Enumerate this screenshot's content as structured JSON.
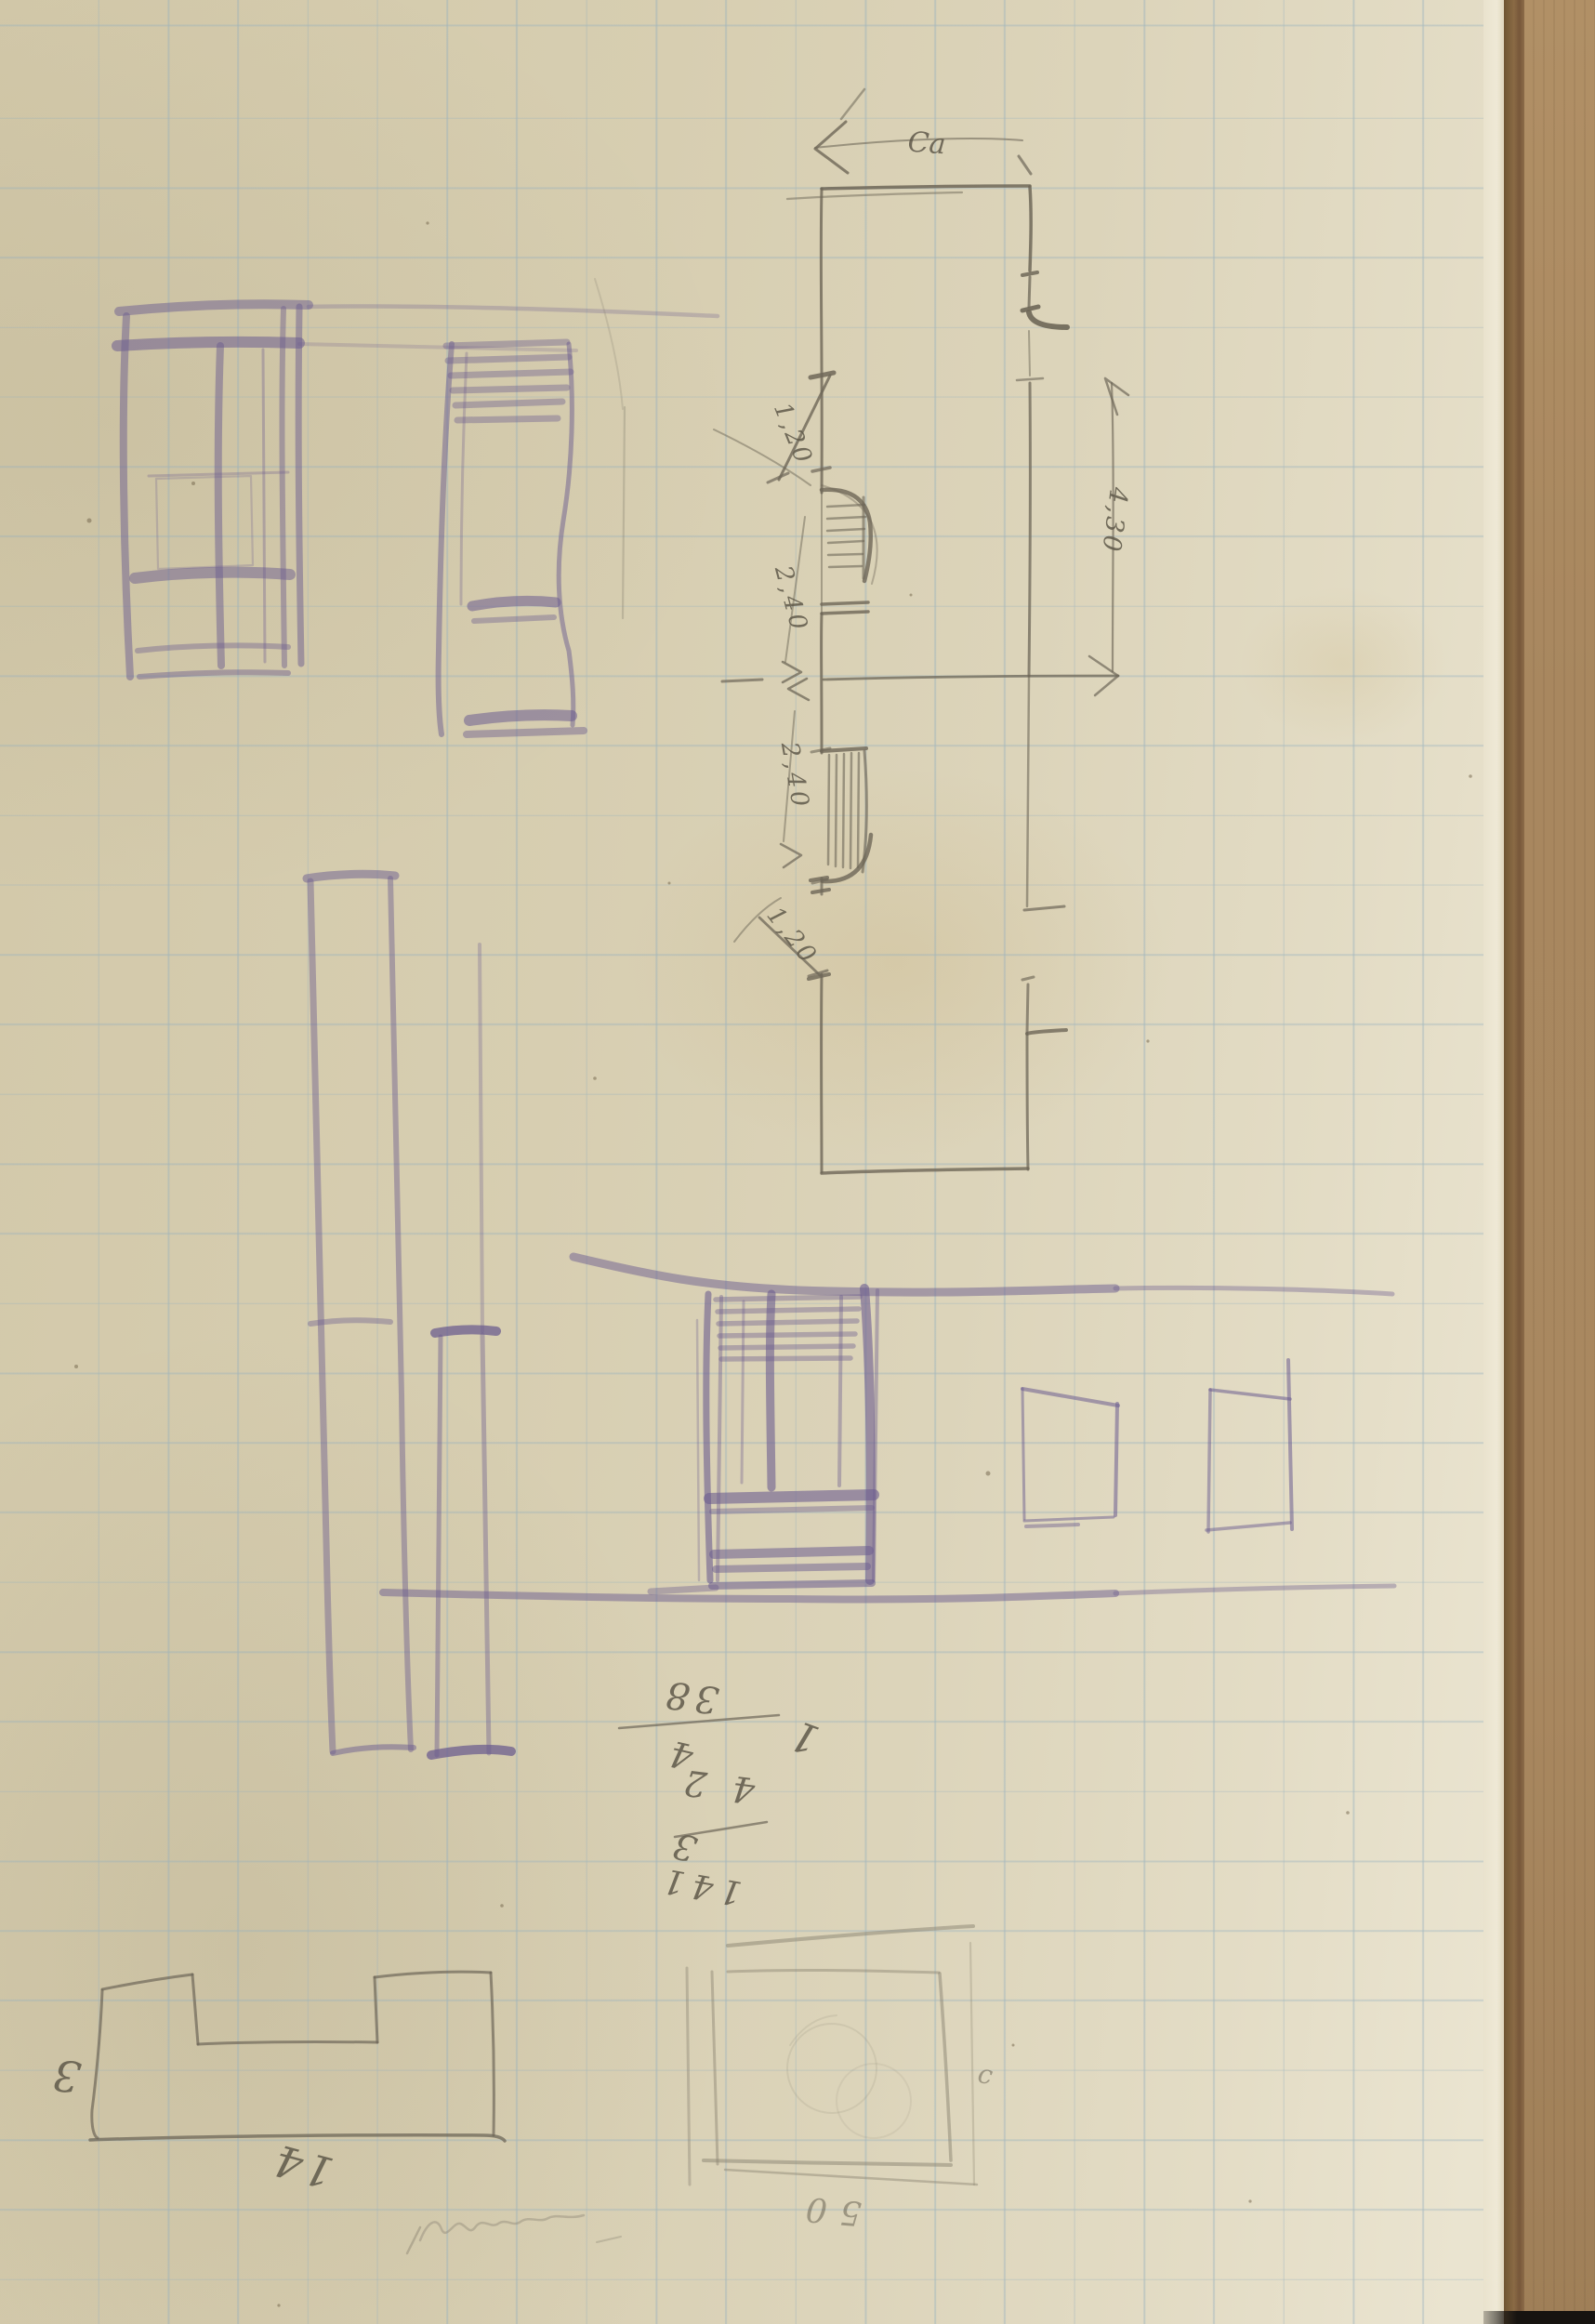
{
  "plan": {
    "label_span": "Ca",
    "dim_jamb_upper": "1,20",
    "dim_window_upper": "2,40",
    "dim_height": "4,30",
    "dim_window_lower": "2,40",
    "dim_jamb_lower": "1,20"
  },
  "calculation": {
    "sum": "38",
    "row_a": "4",
    "row_b": "42",
    "row_c": "3",
    "row_d": "141",
    "stray": "1"
  },
  "floorplan_small": {
    "label_height": "3",
    "label_width": "14"
  },
  "square_sketch": {
    "label_side": "c",
    "label_bottom": "50"
  },
  "colors": {
    "paper": "#d8cfb2",
    "grid_line": "#9fb6c2",
    "graphite": "#6e6758",
    "violet_pencil": "#6c5d8f",
    "cardboard": "#a9875f"
  }
}
